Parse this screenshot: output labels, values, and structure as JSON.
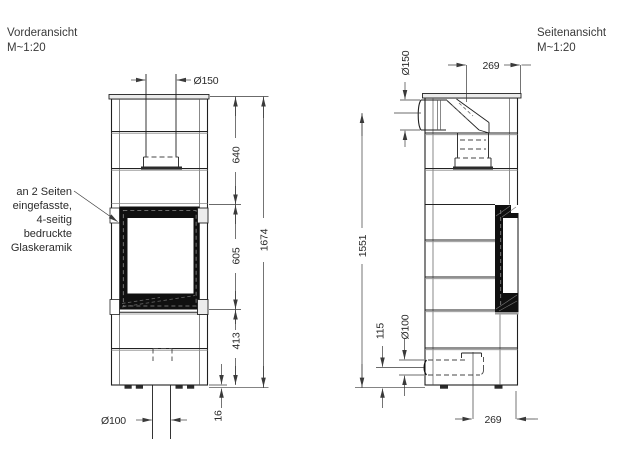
{
  "front_view": {
    "title": "Vorderansicht",
    "scale": "M~1:20",
    "dims": {
      "flue_diameter": "Ø150",
      "segment_top": "640",
      "segment_door": "605",
      "segment_base": "413",
      "overall_height": "1674",
      "foot_height": "16",
      "air_diameter": "Ø100"
    },
    "annotation": {
      "lines": [
        "an 2 Seiten",
        "eingefasste,",
        "4-seitig",
        "bedruckte",
        "Glaskeramik"
      ]
    }
  },
  "side_view": {
    "title": "Seitenansicht",
    "scale": "M~1:20",
    "dims": {
      "flue_diameter": "Ø150",
      "flue_offset": "269",
      "flue_axis_height": "1551",
      "air_height": "115",
      "air_diameter": "Ø100",
      "air_offset": "269"
    }
  },
  "colors": {
    "line": "#1f1f1f",
    "glass_frame": "#101010",
    "background": "#ffffff"
  }
}
